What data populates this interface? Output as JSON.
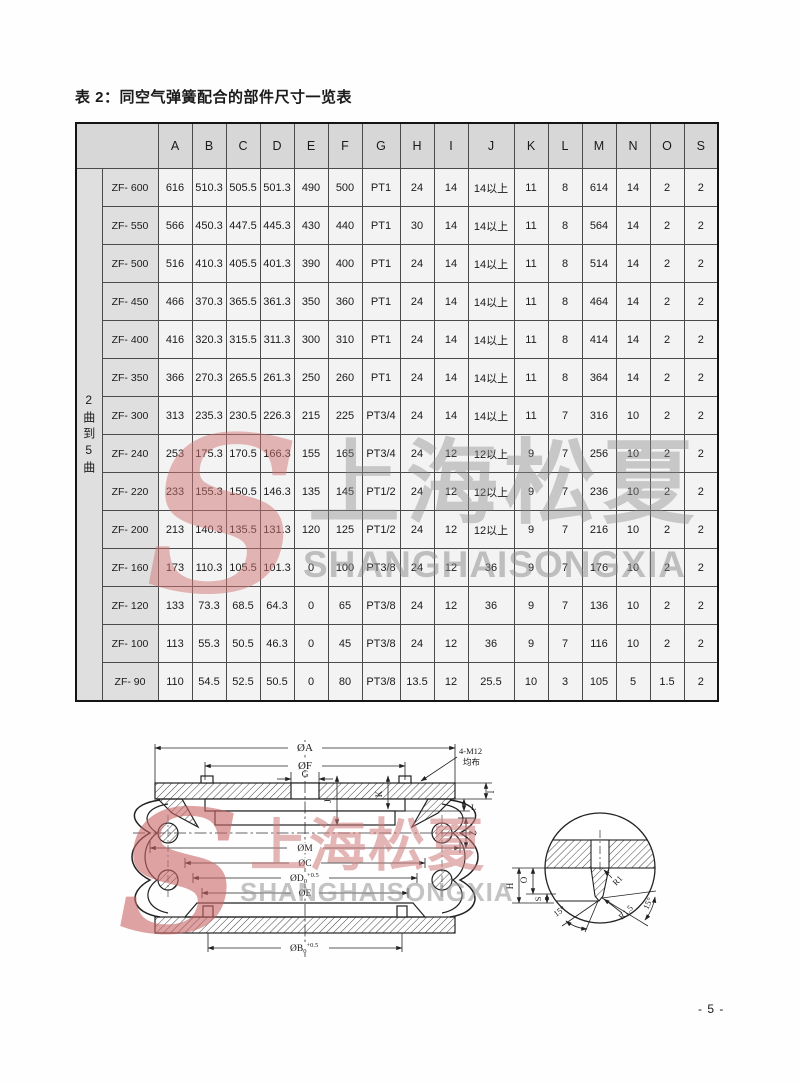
{
  "page": {
    "title": "表 2：同空气弹簧配合的部件尺寸一览表",
    "page_number": "- 5 -"
  },
  "table": {
    "group_label": "2曲到5曲",
    "columns": [
      "A",
      "B",
      "C",
      "D",
      "E",
      "F",
      "G",
      "H",
      "I",
      "J",
      "K",
      "L",
      "M",
      "N",
      "O",
      "S"
    ],
    "rows": [
      {
        "model": "ZF- 600",
        "values": [
          "616",
          "510.3",
          "505.5",
          "501.3",
          "490",
          "500",
          "PT1",
          "24",
          "14",
          "14以上",
          "11",
          "8",
          "614",
          "14",
          "2",
          "2"
        ]
      },
      {
        "model": "ZF- 550",
        "values": [
          "566",
          "450.3",
          "447.5",
          "445.3",
          "430",
          "440",
          "PT1",
          "30",
          "14",
          "14以上",
          "11",
          "8",
          "564",
          "14",
          "2",
          "2"
        ]
      },
      {
        "model": "ZF- 500",
        "values": [
          "516",
          "410.3",
          "405.5",
          "401.3",
          "390",
          "400",
          "PT1",
          "24",
          "14",
          "14以上",
          "11",
          "8",
          "514",
          "14",
          "2",
          "2"
        ]
      },
      {
        "model": "ZF- 450",
        "values": [
          "466",
          "370.3",
          "365.5",
          "361.3",
          "350",
          "360",
          "PT1",
          "24",
          "14",
          "14以上",
          "11",
          "8",
          "464",
          "14",
          "2",
          "2"
        ]
      },
      {
        "model": "ZF- 400",
        "values": [
          "416",
          "320.3",
          "315.5",
          "311.3",
          "300",
          "310",
          "PT1",
          "24",
          "14",
          "14以上",
          "11",
          "8",
          "414",
          "14",
          "2",
          "2"
        ]
      },
      {
        "model": "ZF- 350",
        "values": [
          "366",
          "270.3",
          "265.5",
          "261.3",
          "250",
          "260",
          "PT1",
          "24",
          "14",
          "14以上",
          "11",
          "8",
          "364",
          "14",
          "2",
          "2"
        ]
      },
      {
        "model": "ZF- 300",
        "values": [
          "313",
          "235.3",
          "230.5",
          "226.3",
          "215",
          "225",
          "PT3/4",
          "24",
          "14",
          "14以上",
          "11",
          "7",
          "316",
          "10",
          "2",
          "2"
        ]
      },
      {
        "model": "ZF- 240",
        "values": [
          "253",
          "175.3",
          "170.5",
          "166.3",
          "155",
          "165",
          "PT3/4",
          "24",
          "12",
          "12以上",
          "9",
          "7",
          "256",
          "10",
          "2",
          "2"
        ]
      },
      {
        "model": "ZF- 220",
        "values": [
          "233",
          "155.3",
          "150.5",
          "146.3",
          "135",
          "145",
          "PT1/2",
          "24",
          "12",
          "12以上",
          "9",
          "7",
          "236",
          "10",
          "2",
          "2"
        ]
      },
      {
        "model": "ZF- 200",
        "values": [
          "213",
          "140.3",
          "135.5",
          "131.3",
          "120",
          "125",
          "PT1/2",
          "24",
          "12",
          "12以上",
          "9",
          "7",
          "216",
          "10",
          "2",
          "2"
        ]
      },
      {
        "model": "ZF- 160",
        "values": [
          "173",
          "110.3",
          "105.5",
          "101.3",
          "0",
          "100",
          "PT3/8",
          "24",
          "12",
          "36",
          "9",
          "7",
          "176",
          "10",
          "2",
          "2"
        ]
      },
      {
        "model": "ZF- 120",
        "values": [
          "133",
          "73.3",
          "68.5",
          "64.3",
          "0",
          "65",
          "PT3/8",
          "24",
          "12",
          "36",
          "9",
          "7",
          "136",
          "10",
          "2",
          "2"
        ]
      },
      {
        "model": "ZF- 100",
        "values": [
          "113",
          "55.3",
          "50.5",
          "46.3",
          "0",
          "45",
          "PT3/8",
          "24",
          "12",
          "36",
          "9",
          "7",
          "116",
          "10",
          "2",
          "2"
        ]
      },
      {
        "model": "ZF- 90",
        "values": [
          "110",
          "54.5",
          "52.5",
          "50.5",
          "0",
          "80",
          "PT3/8",
          "13.5",
          "12",
          "25.5",
          "10",
          "3",
          "105",
          "5",
          "1.5",
          "2"
        ]
      }
    ]
  },
  "watermark": {
    "logo_letter": "S",
    "cn": "上海松夏",
    "en": "SHANGHAISONGXIA",
    "logo_color": "#cf7373",
    "text_color": "#8a8a8a"
  },
  "diagram": {
    "dim_a": "ØA",
    "dim_f": "ØF",
    "dim_g": "G",
    "bolt_note_1": "4-M12",
    "bolt_note_2": "均布",
    "dim_j": "J",
    "dim_k": "K",
    "dim_i": "I",
    "dim_l": "L",
    "dim_z": "Z",
    "dim_m": "ØM",
    "dim_c": "ØC",
    "dim_d_base": "ØD",
    "dim_d_sub": "0",
    "dim_d_sup": "+0.5",
    "dim_e": "ØE",
    "dim_b_base": "ØB",
    "dim_b_sub": "0",
    "dim_b_sup": "+0.5",
    "detail": {
      "dim_h": "H",
      "dim_o": "O",
      "dim_s": "S",
      "r1": "R1",
      "r15": "R1.5",
      "angle_left": "15°",
      "angle_right": "15°"
    }
  }
}
